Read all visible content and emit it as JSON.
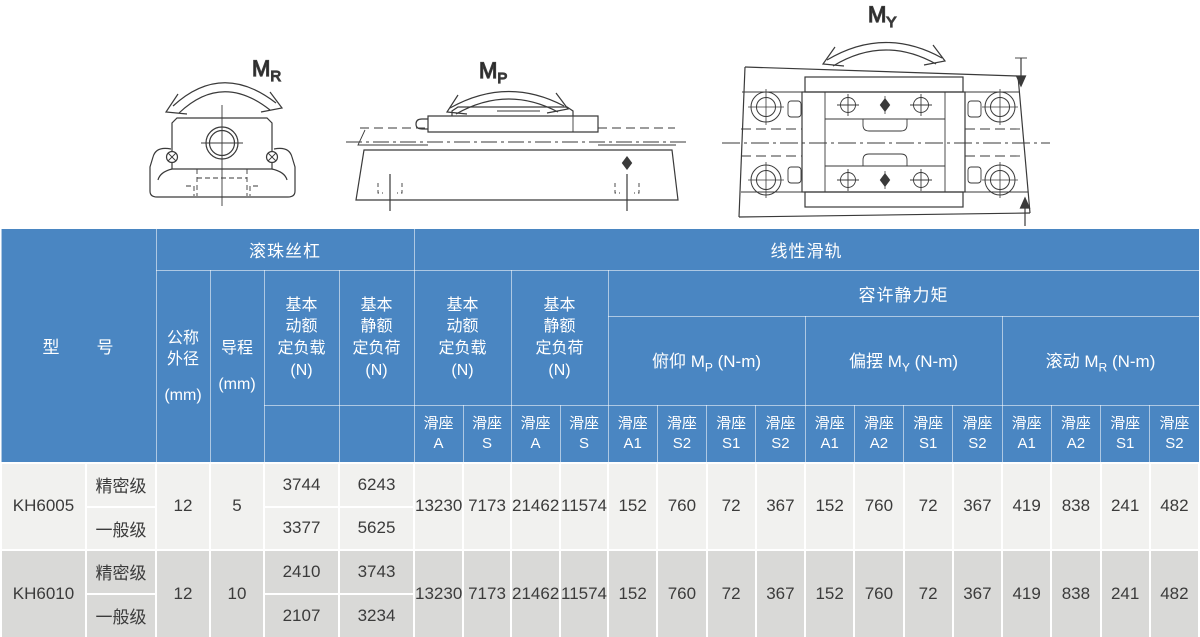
{
  "diagrams": {
    "moment_labels": [
      {
        "symbol": "M",
        "subscript": "R"
      },
      {
        "symbol": "M",
        "subscript": "P"
      },
      {
        "symbol": "M",
        "subscript": "Y"
      }
    ]
  },
  "table": {
    "colors": {
      "header_bg": "#4a86c2",
      "row_light": "#f1f1ef",
      "row_dark": "#d9d9d7",
      "header_text": "#ffffff",
      "data_text": "#3b3b3b"
    },
    "header": {
      "model": "型　　号",
      "ball_screw_group": "滚珠丝杠",
      "linear_group": "线性滑轨",
      "moment_group": "容许静力矩",
      "outer_dia_lines": "公称\n外径",
      "outer_dia_unit": "(mm)",
      "lead_lines": "导程",
      "lead_unit": "(mm)",
      "bs_dynamic_lines": "基本\n动额\n定负载\n(N)",
      "bs_static_lines": "基本\n静额\n定负荷\n(N)",
      "lin_dynamic_lines": "基本\n动额\n定负载\n(N)",
      "lin_static_lines": "基本\n静额\n定负荷\n(N)",
      "moments": [
        {
          "prefix": "俯仰",
          "symbol": "M",
          "subscript": "P",
          "unit": "(N-m)"
        },
        {
          "prefix": "偏摆",
          "symbol": "M",
          "subscript": "Y",
          "unit": "(N-m)"
        },
        {
          "prefix": "滚动",
          "symbol": "M",
          "subscript": "R",
          "unit": "(N-m)"
        }
      ],
      "slider": "滑座",
      "slider_codes": [
        "A",
        "S",
        "A",
        "S",
        "A1",
        "S2",
        "S1",
        "S2",
        "A1",
        "A2",
        "S1",
        "S2",
        "A1",
        "A2",
        "S1",
        "S2"
      ]
    },
    "rows": [
      {
        "model": "KH6005",
        "outer_dia": "12",
        "lead": "5",
        "grades": [
          {
            "name": "精密级",
            "dynamic": "3744",
            "static": "6243"
          },
          {
            "name": "一般级",
            "dynamic": "3377",
            "static": "5625"
          }
        ],
        "linear_values": [
          "13230",
          "7173",
          "21462",
          "11574",
          "152",
          "760",
          "72",
          "367",
          "152",
          "760",
          "72",
          "367",
          "419",
          "838",
          "241",
          "482"
        ]
      },
      {
        "model": "KH6010",
        "outer_dia": "12",
        "lead": "10",
        "grades": [
          {
            "name": "精密级",
            "dynamic": "2410",
            "static": "3743"
          },
          {
            "name": "一般级",
            "dynamic": "2107",
            "static": "3234"
          }
        ],
        "linear_values": [
          "13230",
          "7173",
          "21462",
          "11574",
          "152",
          "760",
          "72",
          "367",
          "152",
          "760",
          "72",
          "367",
          "419",
          "838",
          "241",
          "482"
        ]
      }
    ]
  }
}
